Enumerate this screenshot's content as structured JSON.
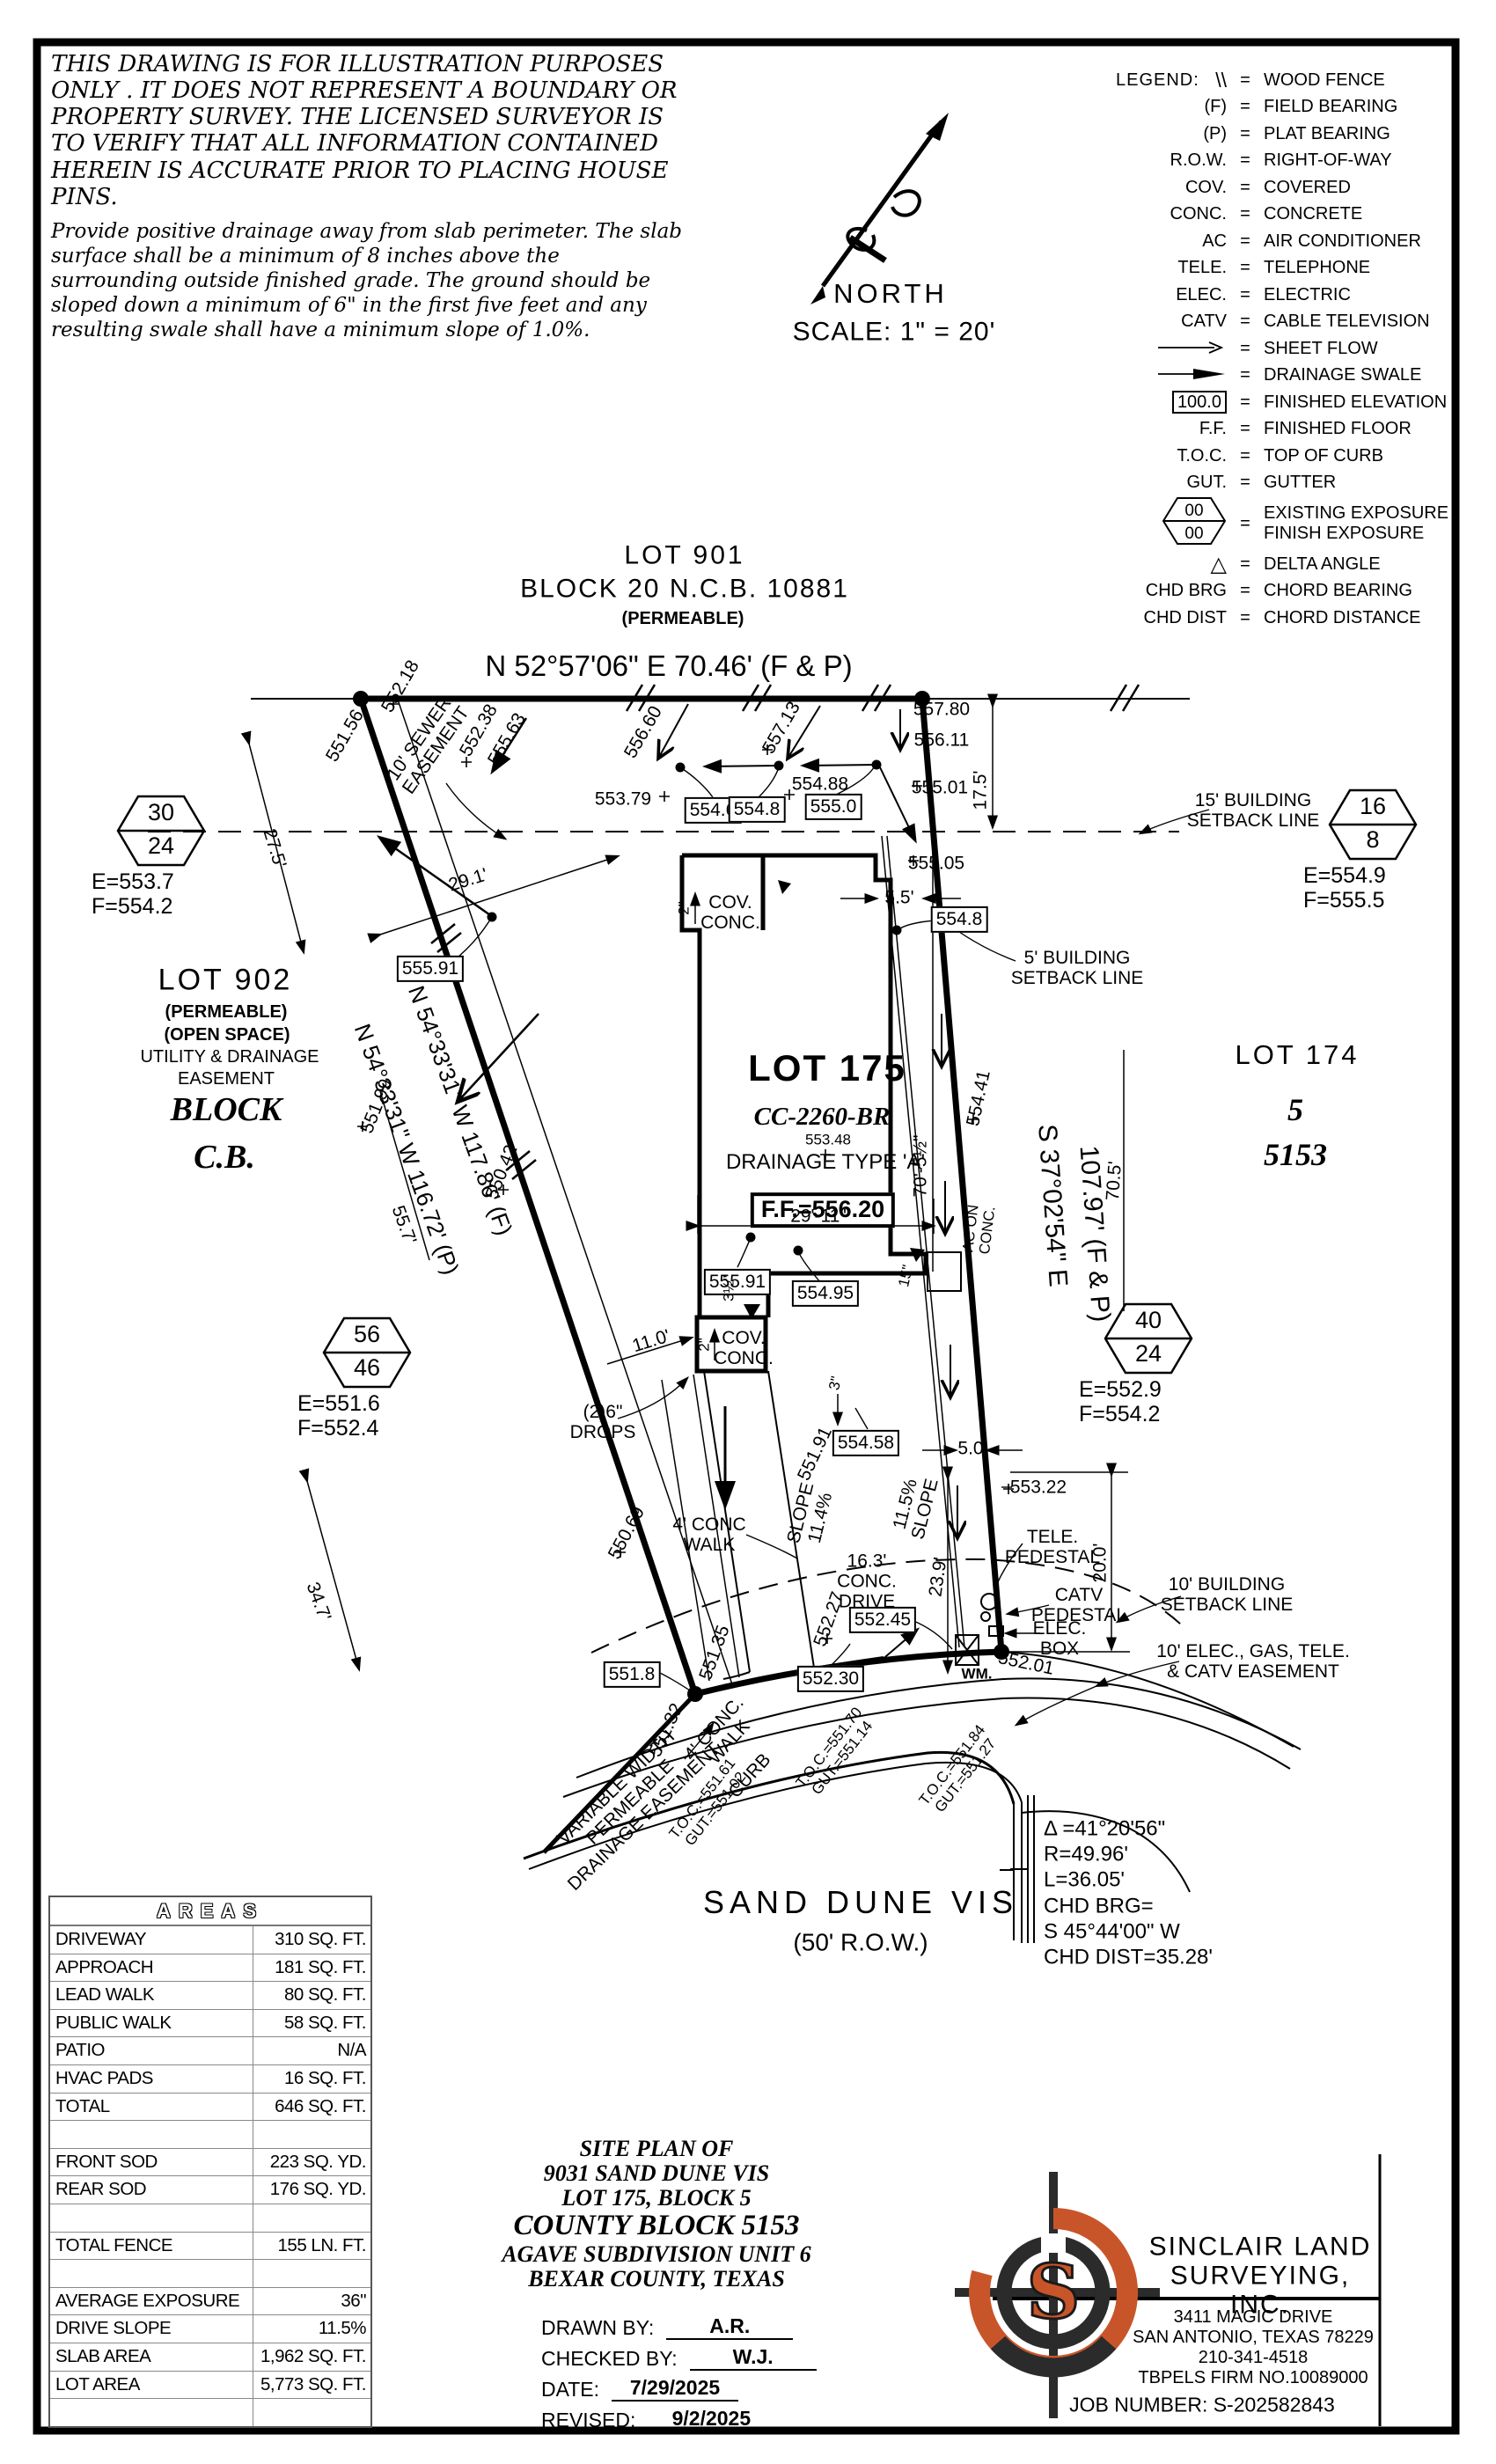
{
  "disclaimer": {
    "para1": "THIS DRAWING IS FOR ILLUSTRATION PURPOSES ONLY . IT DOES NOT REPRESENT A BOUNDARY OR PROPERTY SURVEY. THE LICENSED SURVEYOR IS TO VERIFY THAT ALL INFORMATION CONTAINED HEREIN IS ACCURATE PRIOR TO PLACING HOUSE PINS.",
    "para2": "Provide positive drainage away from slab perimeter. The slab surface shall be a minimum of 8 inches above the surrounding outside finished grade. The ground should be sloped down a minimum of 6\" in the first five feet and any resulting swale shall have a minimum slope of 1.0%."
  },
  "legend": {
    "title": "LEGEND:",
    "rows": [
      {
        "type": "slashes",
        "sym": "\\\\",
        "desc": "WOOD FENCE"
      },
      {
        "type": "text",
        "sym": "(F)",
        "desc": "FIELD BEARING"
      },
      {
        "type": "text",
        "sym": "(P)",
        "desc": "PLAT BEARING"
      },
      {
        "type": "text",
        "sym": "R.O.W.",
        "desc": "RIGHT-OF-WAY"
      },
      {
        "type": "text",
        "sym": "COV.",
        "desc": "COVERED"
      },
      {
        "type": "text",
        "sym": "CONC.",
        "desc": "CONCRETE"
      },
      {
        "type": "text",
        "sym": "AC",
        "desc": "AIR CONDITIONER"
      },
      {
        "type": "text",
        "sym": "TELE.",
        "desc": "TELEPHONE"
      },
      {
        "type": "text",
        "sym": "ELEC.",
        "desc": "ELECTRIC"
      },
      {
        "type": "text",
        "sym": "CATV",
        "desc": "CABLE TELEVISION"
      },
      {
        "type": "arrow-open",
        "sym": "",
        "desc": "SHEET FLOW"
      },
      {
        "type": "arrow-solid",
        "sym": "",
        "desc": "DRAINAGE SWALE"
      },
      {
        "type": "box",
        "sym": "100.0",
        "desc": "FINISHED ELEVATION"
      },
      {
        "type": "text",
        "sym": "F.F.",
        "desc": "FINISHED FLOOR"
      },
      {
        "type": "text",
        "sym": "T.O.C.",
        "desc": "TOP OF CURB"
      },
      {
        "type": "text",
        "sym": "GUT.",
        "desc": "GUTTER"
      },
      {
        "type": "hex",
        "sym_top": "00",
        "sym_bot": "00",
        "desc": "EXISTING EXPOSURE\nFINISH EXPOSURE"
      },
      {
        "type": "delta",
        "sym": "△",
        "desc": "DELTA ANGLE"
      },
      {
        "type": "text",
        "sym": "CHD BRG",
        "desc": "CHORD BEARING"
      },
      {
        "type": "text",
        "sym": "CHD DIST",
        "desc": "CHORD DISTANCE"
      }
    ]
  },
  "north": {
    "label": "NORTH",
    "scale": "SCALE: 1\" = 20'"
  },
  "plan": {
    "lots": {
      "l901a": "LOT 901",
      "l901b": "BLOCK 20 N.C.B. 10881",
      "l901c": "(PERMEABLE)",
      "l902a": "LOT 902",
      "l902b": "(PERMEABLE)",
      "l902c": "(OPEN SPACE)",
      "l902d": "UTILITY & DRAINAGE",
      "l902e": "EASEMENT",
      "l902f": "BLOCK",
      "l902g": "C.B.",
      "l174a": "LOT 174",
      "l174b": "5",
      "l174c": "5153",
      "l175a": "LOT 175",
      "l175b": "CC-2260-BR",
      "l175c": "553.48",
      "l175d": "DRAINAGE TYPE 'A'",
      "ff": "F.F.=556.20"
    },
    "bearings": {
      "top": "N 52°57'06\" E  70.46' (F & P)",
      "west_f": "N 54°33'31\" W 117.86' (F)",
      "west_p": "N 54°33'31\" W 116.72' (P)",
      "east1": "S 37°02'54\" E",
      "east2": "107.97' (F & P)"
    },
    "ev": {
      "e55780": "557.80",
      "e55611": "556.11",
      "e55501": "555.01",
      "e55505": "555.05",
      "e55379": "553.79",
      "e55488": "554.88",
      "e55713": "557.13",
      "e55660": "556.60",
      "e55218": "552.18",
      "e55156": "551.56",
      "e55238": "552.38",
      "e55563": "555.63",
      "e55199": "551.99",
      "e55042": "550.42",
      "e55441": "554.41",
      "e55191": "551.91",
      "e55322": "553.22",
      "e55069": "550.69",
      "e55135": "551.35",
      "e55227": "552.27",
      "e55132": "551.32",
      "e55201": "552.01"
    },
    "box": {
      "b5546": "554.6",
      "b5548a": "554.8",
      "b5550": "555.0",
      "b5548b": "554.8",
      "b55591a": "555.91",
      "b55591b": "555.91",
      "b55495": "554.95",
      "b55458": "554.58",
      "b55245": "552.45",
      "b55230": "552.30",
      "b5518": "551.8"
    },
    "dim": {
      "d175": "17.5'",
      "d275": "27.5'",
      "d291": "29.1'",
      "d2911": "29'-11\"",
      "d7052": "70'-5½\"",
      "d705": "70.5'",
      "d55": "5.5'",
      "d50": "5.0'",
      "d110": "11.0'",
      "d200": "20.0'",
      "d239": "23.9'",
      "d347": "34.7'",
      "d557": "55.7'",
      "d2a": "2\"",
      "d2b": "2\"",
      "d35": "3½\"",
      "d15": "15\"",
      "d3": "3\""
    },
    "feat": {
      "sewer": "10' SEWER\nEASEMENT",
      "setback15": "15' BUILDING\nSETBACK LINE",
      "setback5": "5' BUILDING\nSETBACK LINE",
      "setback10": "10' BUILDING\nSETBACK LINE",
      "easement10": "10' ELEC., GAS, TELE.\n& CATV EASEMENT",
      "covconc_u": "COV.\nCONC.",
      "covconc_l": "COV.\nCONC.",
      "acconc": "AC ON\nCONC.",
      "drops": "(2)6\"\nDROPS",
      "walk4a": "4' CONC\nWALK",
      "walk4b": "4' CONC.\nWALK",
      "curb": "CURB",
      "slope_a": "SLOPE\n11.4%",
      "slope_b": "11.5%\nSLOPE",
      "drive": "16.3'\nCONC.\nDRIVE",
      "varwidth": "VARIABLE WIDTH\nPERMEABLE\nDRAINAGE EASEMENT",
      "tele": "TELE.\nPEDESTAL",
      "catv": "CATV\nPEDESTAL",
      "elecbox": "ELEC.\nBOX",
      "wm": "WM.",
      "toc1": "T.O.C.=551.61\nGUT.=551.02",
      "toc2": "T.O.C.=551.70\nGUT.=551.14",
      "toc3": "T.O.C.=551.84\nGUT.=551.27"
    },
    "street": {
      "name": "SAND DUNE VIS",
      "row": "(50' R.O.W.)"
    },
    "hex": {
      "h1": {
        "top": "30",
        "bottom": "24",
        "ef": "E=553.7\nF=554.2"
      },
      "h2": {
        "top": "56",
        "bottom": "46",
        "ef": "E=551.6\nF=552.4"
      },
      "h3": {
        "top": "16",
        "bottom": "8",
        "ef": "E=554.9\nF=555.5"
      },
      "h4": {
        "top": "40",
        "bottom": "24",
        "ef": "E=552.9\nF=554.2"
      }
    },
    "curve": [
      "Δ =41°20'56\"",
      "R=49.96'",
      "L=36.05'",
      "CHD BRG=",
      "S 45°44'00\" W",
      "CHD DIST=35.28'"
    ]
  },
  "areas_table": {
    "title": "AREAS",
    "rows": [
      [
        "DRIVEWAY",
        "310 SQ. FT."
      ],
      [
        "APPROACH",
        "181 SQ. FT."
      ],
      [
        "LEAD WALK",
        "80 SQ. FT."
      ],
      [
        "PUBLIC WALK",
        "58 SQ. FT."
      ],
      [
        "PATIO",
        "N/A"
      ],
      [
        "HVAC PADS",
        "16 SQ. FT."
      ],
      [
        "TOTAL",
        "646 SQ. FT."
      ],
      [
        "",
        ""
      ],
      [
        "FRONT SOD",
        "223 SQ. YD."
      ],
      [
        "REAR SOD",
        "176 SQ. YD."
      ],
      [
        "",
        ""
      ],
      [
        "TOTAL FENCE",
        "155 LN. FT."
      ],
      [
        "",
        ""
      ],
      [
        "AVERAGE EXPOSURE",
        "36\""
      ],
      [
        "DRIVE SLOPE",
        "11.5%"
      ],
      [
        "SLAB AREA",
        "1,962 SQ. FT."
      ],
      [
        "LOT AREA",
        "5,773 SQ. FT."
      ],
      [
        "",
        ""
      ]
    ]
  },
  "title_block": {
    "lines": [
      "SITE PLAN OF",
      "9031 SAND DUNE VIS",
      "LOT 175, BLOCK 5",
      "COUNTY BLOCK 5153",
      "AGAVE SUBDIVISION UNIT 6",
      "BEXAR COUNTY, TEXAS"
    ],
    "credits": [
      {
        "label": "DRAWN BY:",
        "value": "A.R."
      },
      {
        "label": "CHECKED BY:",
        "value": "W.J."
      },
      {
        "label": "DATE:",
        "value": "7/29/2025"
      },
      {
        "label": "REVISED:",
        "value": "9/2/2025"
      }
    ]
  },
  "company": {
    "name": "SINCLAIR LAND\nSURVEYING, INC.",
    "address": "3411 MAGIC DRIVE\nSAN ANTONIO, TEXAS 78229\n210-341-4518\nTBPELS FIRM NO.10089000",
    "job": "JOB NUMBER: S-202582843",
    "logo_letter": "S",
    "accent": "#C8552A"
  }
}
